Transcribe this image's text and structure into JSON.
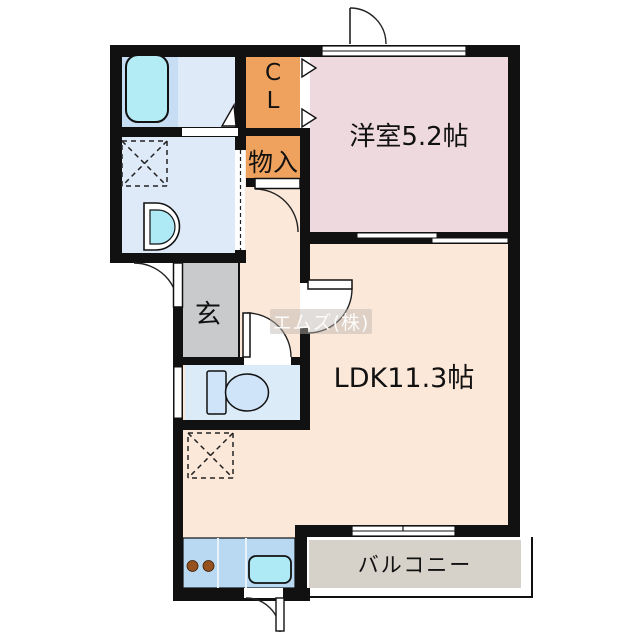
{
  "floorplan": {
    "plan_type": "1LDK",
    "watermark": "エムズ(株)",
    "wall_color": "#111111",
    "rooms": {
      "western_room": {
        "label": "洋室5.2帖",
        "color": "#eed9df"
      },
      "ldk": {
        "label": "LDK11.3帖",
        "color": "#fce8d9"
      },
      "balcony": {
        "label": "バルコニー",
        "color": "#d6d2c9"
      },
      "closet": {
        "line1": "C",
        "line2": "L",
        "color": "#efa25e"
      },
      "storage": {
        "label": "物入",
        "color": "#efa25e"
      },
      "entrance": {
        "label": "玄",
        "color": "#c9cacc"
      },
      "bathroom": {
        "color": "#c6ddf3",
        "fixture": "bathtub"
      },
      "washroom": {
        "color": "#dfeaf8",
        "fixtures": [
          "washing-machine-space",
          "vanity-sink"
        ]
      },
      "toilet_room": {
        "color": "#dcebf8",
        "fixture": "toilet"
      },
      "kitchen": {
        "color": "#b9d9f2",
        "fixtures": [
          "stove-burners",
          "kitchen-sink"
        ]
      }
    },
    "fixture_colors": {
      "bathtub": "#b4ecf6",
      "sinks": "#aeeaf6",
      "burners": "#96511f",
      "toilet": "#cfe4f8"
    }
  }
}
